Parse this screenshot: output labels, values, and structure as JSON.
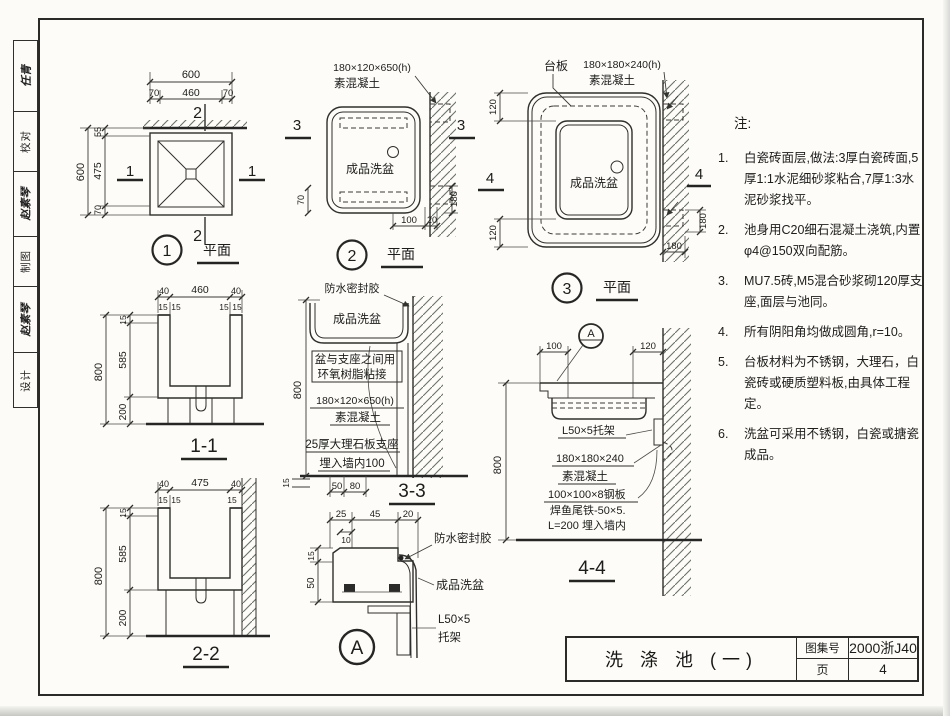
{
  "sidebar": {
    "cells": [
      {
        "text": "任青"
      },
      {
        "text": "校对"
      },
      {
        "text": "赵素琴"
      },
      {
        "text": "制图"
      },
      {
        "text": "赵素琴"
      },
      {
        "text": "设计"
      }
    ]
  },
  "plan1": {
    "no": "1",
    "title": "平面",
    "mark_v": "2",
    "mark_h": "1",
    "dim_600t": "600",
    "dim_70l": "70",
    "dim_460": "460",
    "dim_70r": "70",
    "dim_600l": "600",
    "dim_55": "55",
    "dim_475": "475",
    "dim_70b": "70"
  },
  "plan2": {
    "no": "2",
    "title": "平面",
    "mark": "3",
    "concrete1": "180×120×650(h)",
    "concrete2": "素混凝土",
    "basin": "成品洗盆",
    "dim_70": "70",
    "dim_100": "100",
    "dim_20": "20",
    "dim_180": "180"
  },
  "plan3": {
    "no": "3",
    "title": "平面",
    "mark": "4",
    "counter": "台板",
    "concrete1": "180×180×240(h)",
    "concrete2": "素混凝土",
    "basin": "成品洗盆",
    "dim_120t": "120",
    "dim_120b": "120",
    "dim_180r": "180",
    "dim_180b": "180"
  },
  "s11": {
    "label": "1-1",
    "dim_800": "800",
    "dim_15": "15",
    "dim_585": "585",
    "dim_200": "200",
    "dim_40l": "40",
    "dim_460": "460",
    "dim_40r": "40",
    "dim_15a": "15",
    "dim_15b": "15",
    "dim_15c": "15",
    "dim_15d": "15"
  },
  "s22": {
    "label": "2-2",
    "dim_800": "800",
    "dim_15": "15",
    "dim_585": "585",
    "dim_200": "200",
    "dim_40l": "40",
    "dim_475": "475",
    "dim_40r": "40",
    "dim_15a": "15",
    "dim_15b": "15",
    "dim_15c": "15"
  },
  "s33": {
    "label": "3-3",
    "sealant": "防水密封胶",
    "basin": "成品洗盆",
    "bond1": "盆与支座之间用",
    "bond2": "环氧树脂粘接",
    "concrete1": "180×120×650(h)",
    "concrete2": "素混凝土",
    "support1": "25厚大理石板支座",
    "support2": "埋入墙内100",
    "dim_800": "800",
    "dim_15": "15",
    "dim_50": "50",
    "dim_80": "80"
  },
  "s44": {
    "label": "4-4",
    "detail": "A",
    "dim_100": "100",
    "dim_120": "120",
    "dim_800": "800",
    "bracket": "L50×5托架",
    "concrete1": "180×180×240",
    "concrete2": "素混凝土",
    "plate": "100×100×8钢板",
    "anchor1": "焊鱼尾铁-50×5.",
    "anchor2": "L=200 埋入墙内"
  },
  "dA": {
    "label": "A",
    "sealant": "防水密封胶",
    "basin": "成品洗盆",
    "bracket1": "L50×5",
    "bracket2": "托架",
    "dim_25": "25",
    "dim_45": "45",
    "dim_20": "20",
    "dim_10": "10",
    "dim_15": "15",
    "dim_50": "50"
  },
  "notes": {
    "heading": "注:",
    "items": [
      {
        "no": "1.",
        "text": "白瓷砖面层,做法:3厚白瓷砖面,5厚1:1水泥细砂浆粘合,7厚1:3水泥砂浆找平。"
      },
      {
        "no": "2.",
        "text": "池身用C20细石混凝土浇筑,内置φ4@150双向配筋。"
      },
      {
        "no": "3.",
        "text": "MU7.5砖,M5混合砂浆砌120厚支座,面层与池同。"
      },
      {
        "no": "4.",
        "text": "所有阴阳角均做成圆角,r=10。"
      },
      {
        "no": "5.",
        "text": "台板材料为不锈钢，大理石，白瓷砖或硬质塑料板,由具体工程定。"
      },
      {
        "no": "6.",
        "text": "洗盆可采用不锈钢，白瓷或搪瓷成品。"
      }
    ]
  },
  "titleblock": {
    "title": "洗 涤 池 (一)",
    "atlas_label": "图集号",
    "atlas_no": "2000浙J40",
    "page_label": "页",
    "page_no": "4"
  }
}
